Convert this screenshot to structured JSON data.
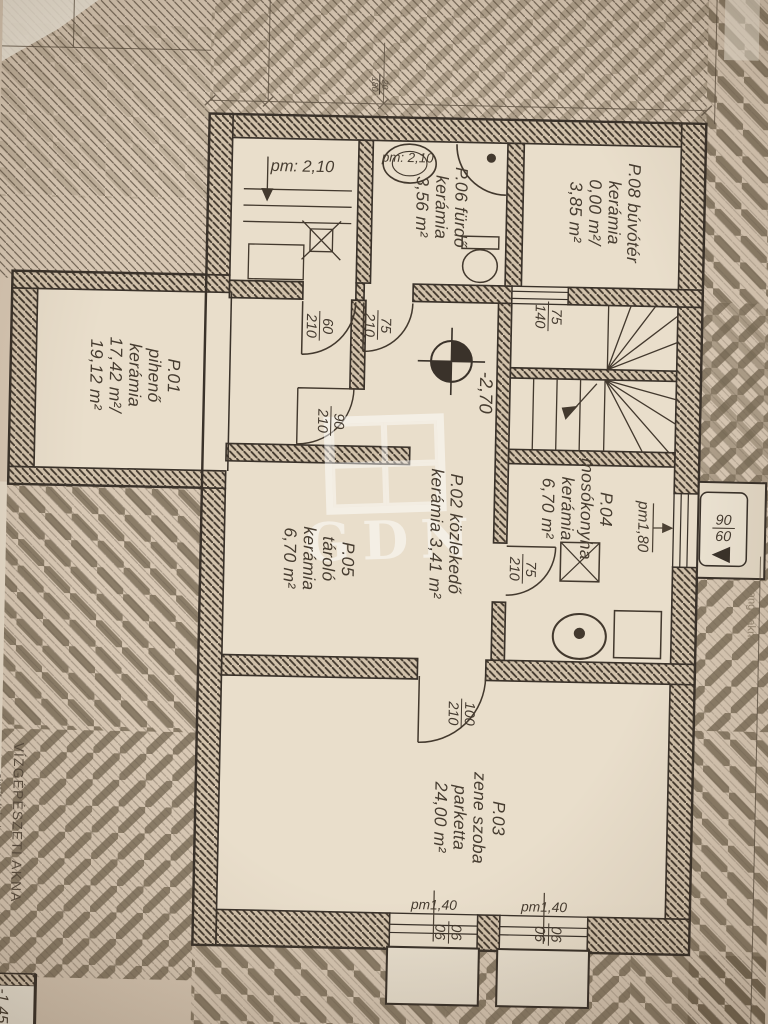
{
  "document": {
    "type": "basement floor plan photo",
    "language": "hu"
  },
  "colors": {
    "paper": "#d8c8b4",
    "room_fill": "#e9decb",
    "ink": "#3a322a",
    "hatch": "#6f6253"
  },
  "rooms": {
    "p01": {
      "line1": "P.01",
      "line2": "pihenő",
      "line3": "kerámia",
      "line4": "17,42 m²/",
      "line5": "19,12 m²"
    },
    "p02": {
      "line1": "P.02 közlekedő",
      "line2": "kerámia 3,41 m²"
    },
    "p03": {
      "line1": "P.03",
      "line2": "zene szoba",
      "line3": "parketta",
      "line4": "24,00 m²"
    },
    "p04": {
      "line1": "P.04",
      "line2": "mosókonyha",
      "line3": "kerámia",
      "line4": "6,70 m²"
    },
    "p05": {
      "line1": "P.05",
      "line2": "tároló",
      "line3": "kerámia",
      "line4": "6,70 m²"
    },
    "p06": {
      "line1": "P.06 fürdő",
      "line2": "kerámia",
      "line3": "3,56 m²"
    },
    "p08": {
      "line1": "P.08 búvótér",
      "line2": "kerámia",
      "line3": "0,00 m²/",
      "line4": "3,85 m²"
    }
  },
  "levels": {
    "entry_room_height": "pm: 2,10",
    "bath_height": "pm: 2,10",
    "floor_level": "-2,70",
    "laundry_parapet": "pm1,80",
    "window_parapet_1": "pm1,40",
    "window_parapet_2": "pm1,40",
    "shaft_level": "-1,45"
  },
  "openings": {
    "door_entry": {
      "w": "60",
      "h": "210"
    },
    "door_bath": {
      "w": "75",
      "h": "210"
    },
    "door_p01": {
      "w": "90",
      "h": "210"
    },
    "door_laundry": {
      "w": "75",
      "h": "210"
    },
    "door_music": {
      "w": "100",
      "h": "210"
    },
    "stair_window": {
      "w": "75",
      "h": "140"
    },
    "side_window": {
      "w": "90",
      "h": "60"
    },
    "cellar_window_1": {
      "w": "90",
      "h": "90"
    },
    "cellar_window_2": {
      "w": "90",
      "h": "90"
    },
    "top_dim": {
      "a": "20",
      "b": "180"
    }
  },
  "annotations": {
    "shaft_title": "VÍZGÉPÉSZETI AKNA",
    "shaft_note": "simított beton",
    "light_well": "angolakna"
  },
  "watermark": {
    "text": "GDN"
  }
}
